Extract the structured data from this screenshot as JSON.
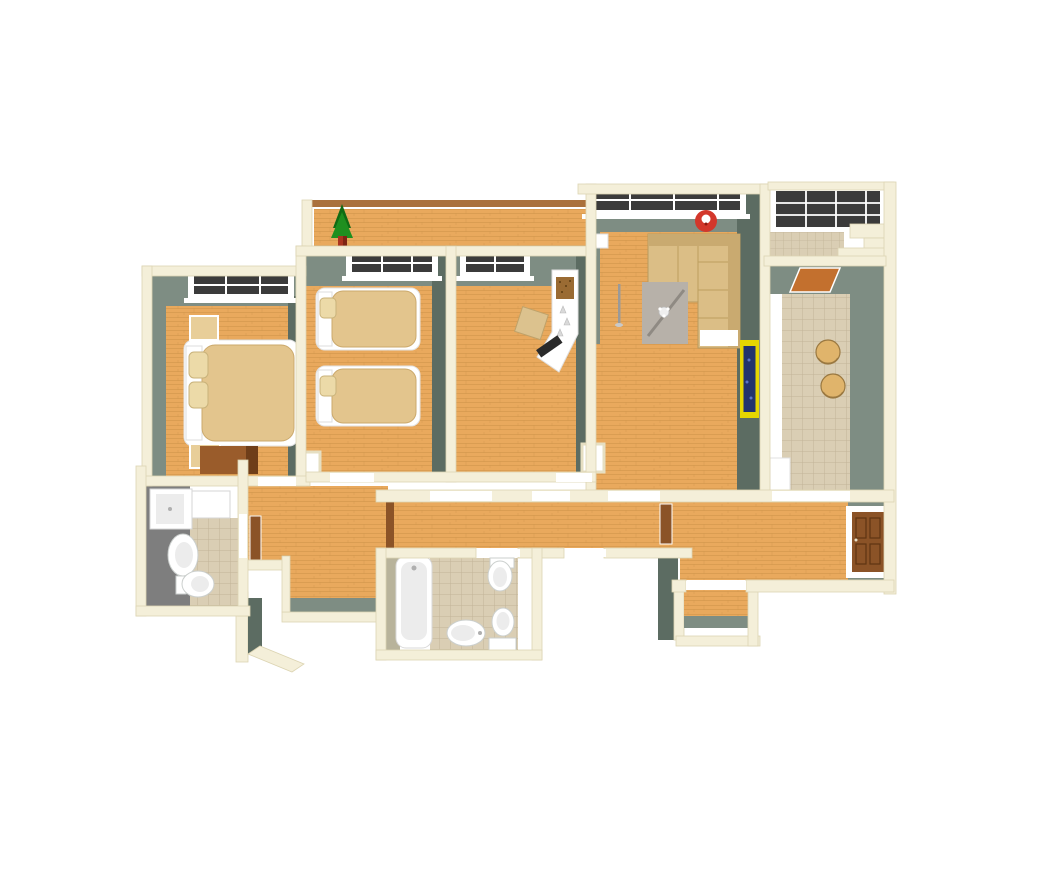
{
  "scene": {
    "type": "apartment-3d-floor-plan-render",
    "view": "top-down perspective, no visible UI chrome or text",
    "rooms": [
      {
        "name": "terrace",
        "items": [
          "wood-deck",
          "brown-railing",
          "potted-conifer-plant"
        ]
      },
      {
        "name": "master-bedroom",
        "items": [
          "window",
          "double-bed",
          "pillows",
          "nightstand-top",
          "nightstand-bottom",
          "wardrobe"
        ]
      },
      {
        "name": "kids-bedroom",
        "items": [
          "window",
          "single-bed-upper",
          "single-bed-lower"
        ]
      },
      {
        "name": "study",
        "items": [
          "window",
          "white-corner-desk",
          "corkboard",
          "keyboard",
          "desk-chair"
        ]
      },
      {
        "name": "living-room",
        "items": [
          "wide-window",
          "red-wall-clock",
          "corner-sofa",
          "white-throw",
          "gray-rug",
          "coffee-table",
          "floor-lamp",
          "wall-radiator-box",
          "yellow-framed-picture"
        ]
      },
      {
        "name": "glazed-balcony",
        "items": [
          "panoramic-glazing",
          "tiled-floor",
          "steps"
        ]
      },
      {
        "name": "kitchen",
        "items": [
          "door-mat",
          "counter-strip",
          "bar-stool-1",
          "bar-stool-2",
          "counter-block"
        ]
      },
      {
        "name": "inner-hall",
        "items": [
          "open-brown-door",
          "wall-niche"
        ]
      },
      {
        "name": "corridor",
        "items": [
          "door-thresholds"
        ]
      },
      {
        "name": "entry-hall",
        "items": [
          "entrance-door",
          "vestibule"
        ]
      },
      {
        "name": "bathroom",
        "items": [
          "bathtub",
          "toilet",
          "bidet",
          "toilet-with-cistern",
          "tiled-floor"
        ]
      },
      {
        "name": "wc",
        "items": [
          "shower-cabin",
          "washing-machine",
          "sink",
          "toilet",
          "slate-floor",
          "tiled-floor"
        ]
      }
    ]
  },
  "palette": {
    "wallTop": "#F4EFD9",
    "wallEdge": "#DCD4B2",
    "wallFace": "#7E8D83",
    "wallFaceDark": "#5C6C62",
    "wood": "#E9A95D",
    "woodDark": "#C98F45",
    "tile": "#DACEB4",
    "tileLine": "#C0B295",
    "slate": "#7E7E7E",
    "glass": "#3B3B3B",
    "bedLinen": "#E3C58D",
    "pillow": "#ECDAA8",
    "nightstand": "#E8CE99",
    "wardrobe": "#9A5C2B",
    "wardrobeDark": "#6F3E19",
    "doorBrown": "#8B5327",
    "doorDark": "#5E3512",
    "sofa": "#DBBE86",
    "sofaDark": "#C9AA70",
    "rug": "#B7B1A9",
    "rugLine": "#8F8A83",
    "plant": "#1F8F1F",
    "plantDark": "#116B14",
    "pot": "#A93420",
    "clockRed": "#D3372B",
    "pictureFrame": "#E6D600",
    "pictureArt": "#22336D",
    "stool": "#E0B46B",
    "stoolEdge": "#9A7840",
    "railBrown": "#AA713C",
    "matOrange": "#C3702E",
    "fixture": "#FFFFFF",
    "fixtureInner": "#ECECEC",
    "fixtureEdge": "#CBCFCD",
    "olive": "#B8B39B"
  }
}
